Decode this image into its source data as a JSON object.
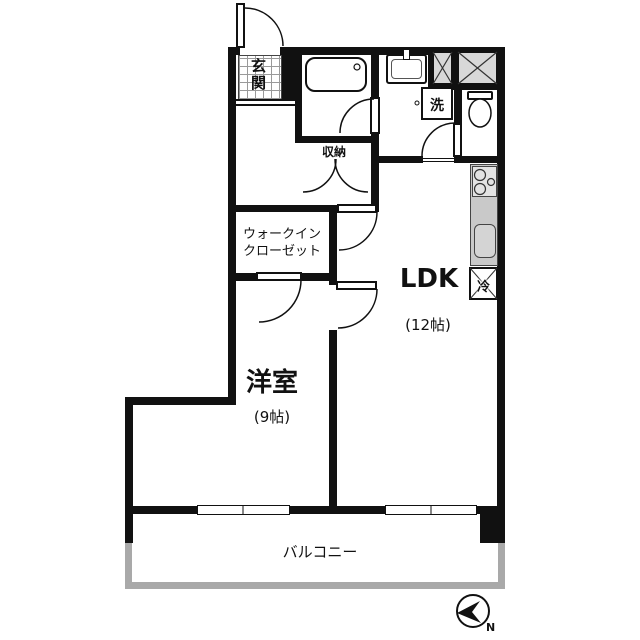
{
  "floorplan": {
    "entrance_label": "玄関",
    "storage_label": "収納",
    "wic_line1": "ウォークイン",
    "wic_line2": "クローゼット",
    "ldk_label": "LDK",
    "ldk_size": "(12帖)",
    "western_room_label": "洋室",
    "western_room_size": "(9帖)",
    "balcony_label": "バルコニー",
    "laundry_label": "洗",
    "fridge_label": "冷",
    "compass_label": "N",
    "colors": {
      "wall": "#111111",
      "kitchen_counter": "#c9c9c9",
      "shaft_fill": "#d8d8d8",
      "railing": "#a9a9a9"
    }
  }
}
